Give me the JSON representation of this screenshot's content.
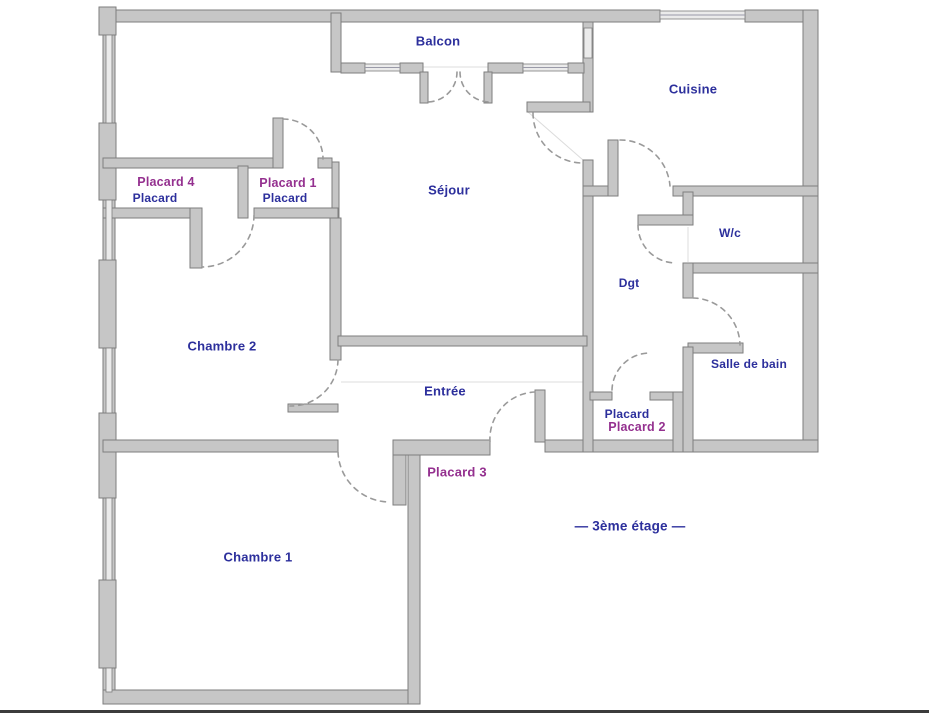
{
  "plan": {
    "floor_label": "—  3ème étage  —",
    "rooms": {
      "balcon": "Balcon",
      "cuisine": "Cuisine",
      "sejour": "Séjour",
      "wc": "W/c",
      "dgt": "Dgt",
      "salle_de_bain": "Salle de bain",
      "entree": "Entrée",
      "chambre1": "Chambre 1",
      "chambre2": "Chambre 2"
    },
    "closets": {
      "placard1_annotation": "Placard 1",
      "placard1_original": "Placard",
      "placard2_annotation": "Placard 2",
      "placard2_original": "Placard",
      "placard3_annotation": "Placard 3",
      "placard4_annotation": "Placard 4",
      "placard4_original": "Placard"
    }
  },
  "colors": {
    "label_blue": "#2c2f9c",
    "label_purple": "#94308f",
    "wall_fill": "#c6c6c6",
    "wall_stroke": "#7e7e7e",
    "window_fill": "#ebebeb",
    "door_arc": "#9a9a9a",
    "background": "#ffffff",
    "bottom_line": "#3c3c3c"
  }
}
